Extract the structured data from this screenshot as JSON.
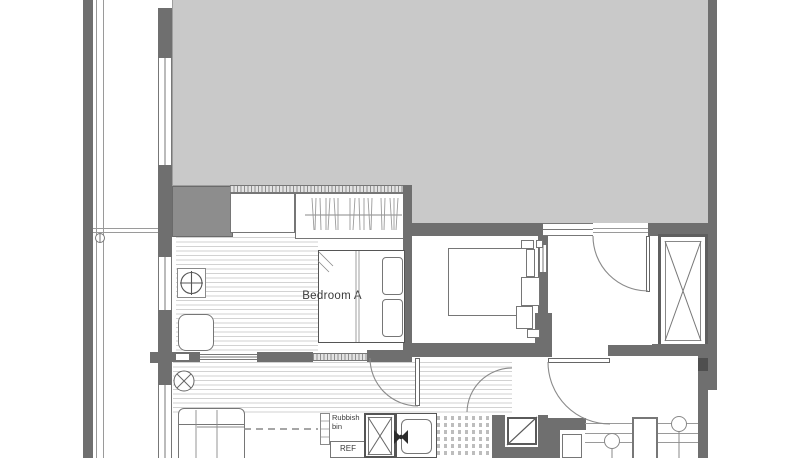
{
  "labels": {
    "bedroom_a": "Bedroom A",
    "rubbish_bin": "Rubbish bin",
    "refrigerator": "REF"
  },
  "colors": {
    "wall": "#6f6f6f",
    "wall_mid": "#8d8d8d",
    "neighbor": "#c9c9c9",
    "line": "#9a9a9a",
    "floor_line": "#d2d2d2",
    "text": "#3a3a3a",
    "paper": "#ffffff"
  },
  "icons": [
    "door-swing-arc-icon",
    "door-leaf-icon",
    "shaft-cross-icon",
    "duct-diagonal-icon",
    "hanging-clothes-icon",
    "ceiling-fixture-cross-icon",
    "floor-fixture-cross-icon",
    "sink-faucet-icon",
    "grid-marker-icon",
    "door-handle-circle-icon",
    "bed-icon",
    "pillow-icon",
    "sofa-icon",
    "armchair-icon",
    "wardrobe-icon"
  ]
}
